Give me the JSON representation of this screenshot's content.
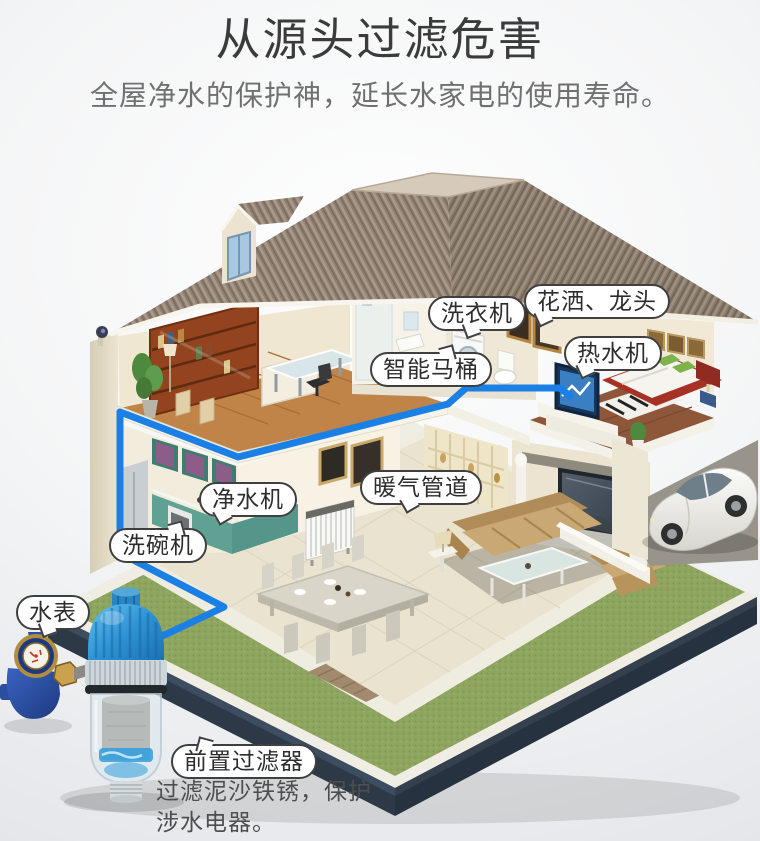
{
  "header": {
    "title": "从源头过滤危害",
    "subtitle": "全屋净水的保护神，延长水家电的使用寿命。"
  },
  "callouts": {
    "washing_machine": "洗衣机",
    "shower_faucet": "花洒、龙头",
    "water_heater": "热水机",
    "smart_toilet": "智能马桶",
    "water_purifier": "净水机",
    "heating_pipes": "暖气管道",
    "dishwasher": "洗碗机",
    "water_meter": "水表",
    "prefilter": "前置过滤器"
  },
  "footer": {
    "line1": "过滤泥沙铁锈，保护",
    "line2": "涉水电器。"
  },
  "colors": {
    "pipe_blue": "#1a80e6",
    "label_border": "#3f3f3f",
    "roof_brown": "#91806f",
    "lawn_green": "#8ea55f",
    "base_dark": "#2e3947",
    "filter_blue": "#2b84c4",
    "title_text": "#3b3b3b",
    "subtitle_text": "#707070"
  }
}
